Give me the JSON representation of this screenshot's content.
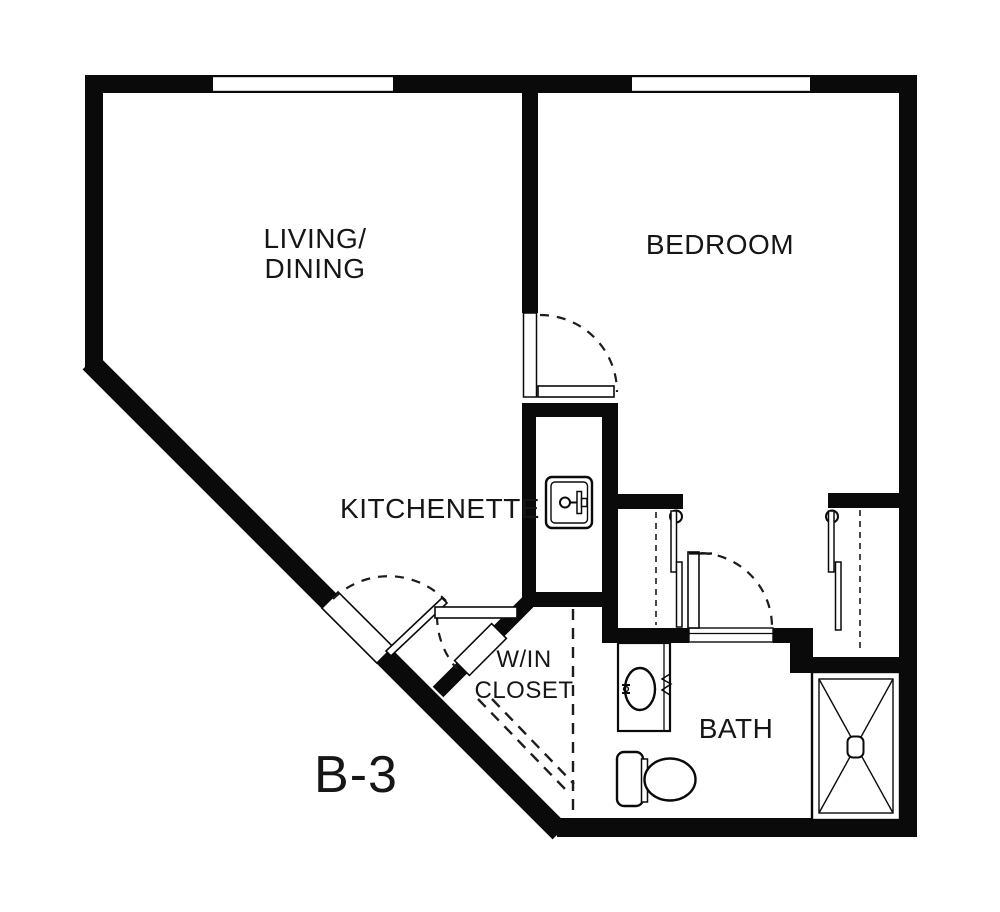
{
  "floor_plan": {
    "unit_label": "B-3",
    "labels": {
      "living_line1": "LIVING/",
      "living_line2": "DINING",
      "bedroom": "BEDROOM",
      "kitchenette": "KITCHENETTE",
      "win_closet_line1": "W/IN",
      "win_closet_line2": "CLOSET",
      "bath": "BATH"
    },
    "colors": {
      "walls": "#0a0a0a",
      "background": "#ffffff",
      "text": "#161616"
    }
  }
}
